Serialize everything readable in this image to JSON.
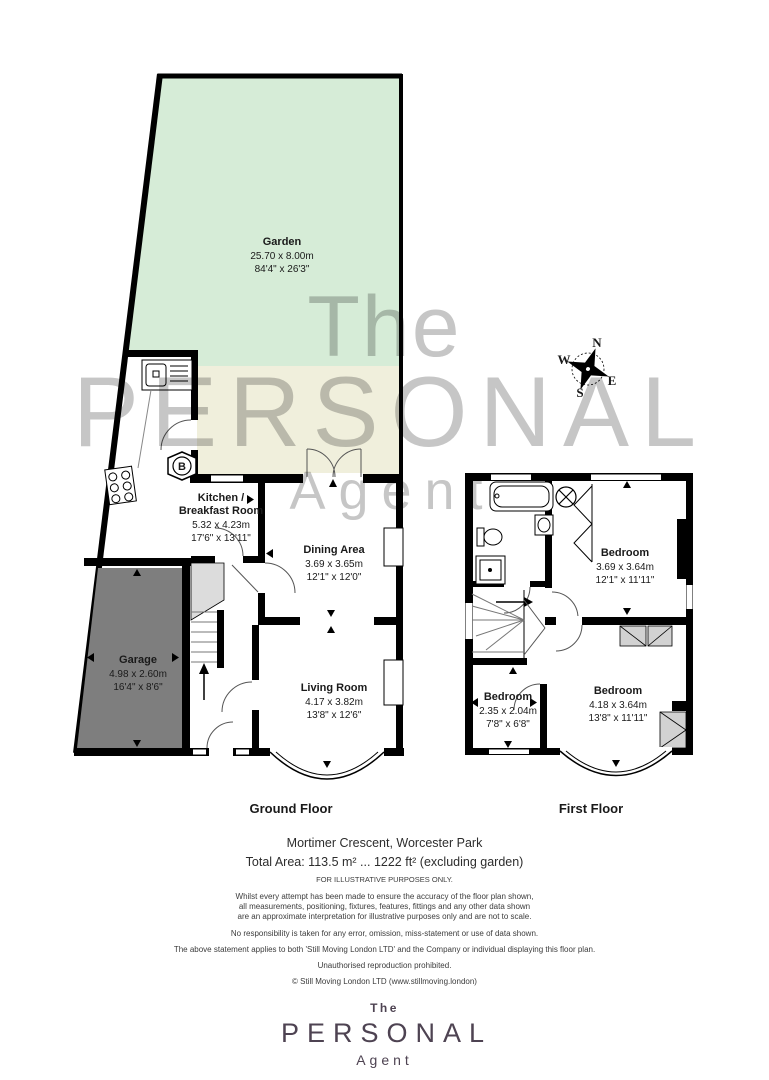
{
  "colors": {
    "garden_green": "#d6ecd7",
    "patio_cream": "#f0efdc",
    "garage_grey": "#7e7e7e",
    "wardrobe_grey": "#d2d2d2",
    "landing_grey": "#dcdcdc",
    "watermark_grey": "#c6c6c6",
    "logo_purple": "#4e4352"
  },
  "watermark": {
    "the": "The",
    "personal": "PERSONAL",
    "agent": "Agent"
  },
  "compass": {
    "north": "N",
    "east": "E",
    "south": "S",
    "west": "W"
  },
  "ground_floor": {
    "title": "Ground Floor",
    "garden": {
      "name": "Garden",
      "metric": "25.70 x 8.00m",
      "imperial": "84'4\" x 26'3\""
    },
    "kitchen": {
      "name_line1": "Kitchen /",
      "name_line2": "Breakfast Room",
      "metric": "5.32 x 4.23m",
      "imperial": "17'6\" x 13'11\""
    },
    "dining": {
      "name": "Dining Area",
      "metric": "3.69 x 3.65m",
      "imperial": "12'1\" x 12'0\""
    },
    "living": {
      "name": "Living Room",
      "metric": "4.17 x 3.82m",
      "imperial": "13'8\" x 12'6\""
    },
    "garage": {
      "name": "Garage",
      "metric": "4.98 x 2.60m",
      "imperial": "16'4\" x 8'6\""
    },
    "boiler_label": "B"
  },
  "first_floor": {
    "title": "First Floor",
    "bedroom1": {
      "name": "Bedroom",
      "metric": "3.69 x 3.64m",
      "imperial": "12'1\" x 11'11\""
    },
    "bedroom2": {
      "name": "Bedroom",
      "metric": "2.35 x 2.04m",
      "imperial": "7'8\" x 6'8\""
    },
    "bedroom3": {
      "name": "Bedroom",
      "metric": "4.18 x 3.64m",
      "imperial": "13'8\" x 11'11\""
    }
  },
  "footer": {
    "address": "Mortimer Crescent, Worcester Park",
    "total_area": "Total Area: 113.5 m² ... 1222 ft² (excluding garden)",
    "illustrative": "FOR ILLUSTRATIVE PURPOSES ONLY.",
    "disclaimer_line1": "Whilst every attempt has been made to ensure the accuracy of the floor plan shown,",
    "disclaimer_line2": "all measurements, positioning, fixtures, features, fittings and any other data shown",
    "disclaimer_line3": "are an approximate interpretation for illustrative purposes only and are not to scale.",
    "disclaimer_line4": "No responsibility is taken for any error, omission, miss-statement or use of data shown.",
    "disclaimer_line5": "The above statement applies to both 'Still Moving London LTD' and the Company or individual displaying this floor plan.",
    "disclaimer_line6": "Unauthorised reproduction prohibited.",
    "copyright": "© Still Moving London LTD (www.stillmoving.london)"
  },
  "logo": {
    "the": "The",
    "personal": "PERSONAL",
    "agent": "Agent"
  }
}
